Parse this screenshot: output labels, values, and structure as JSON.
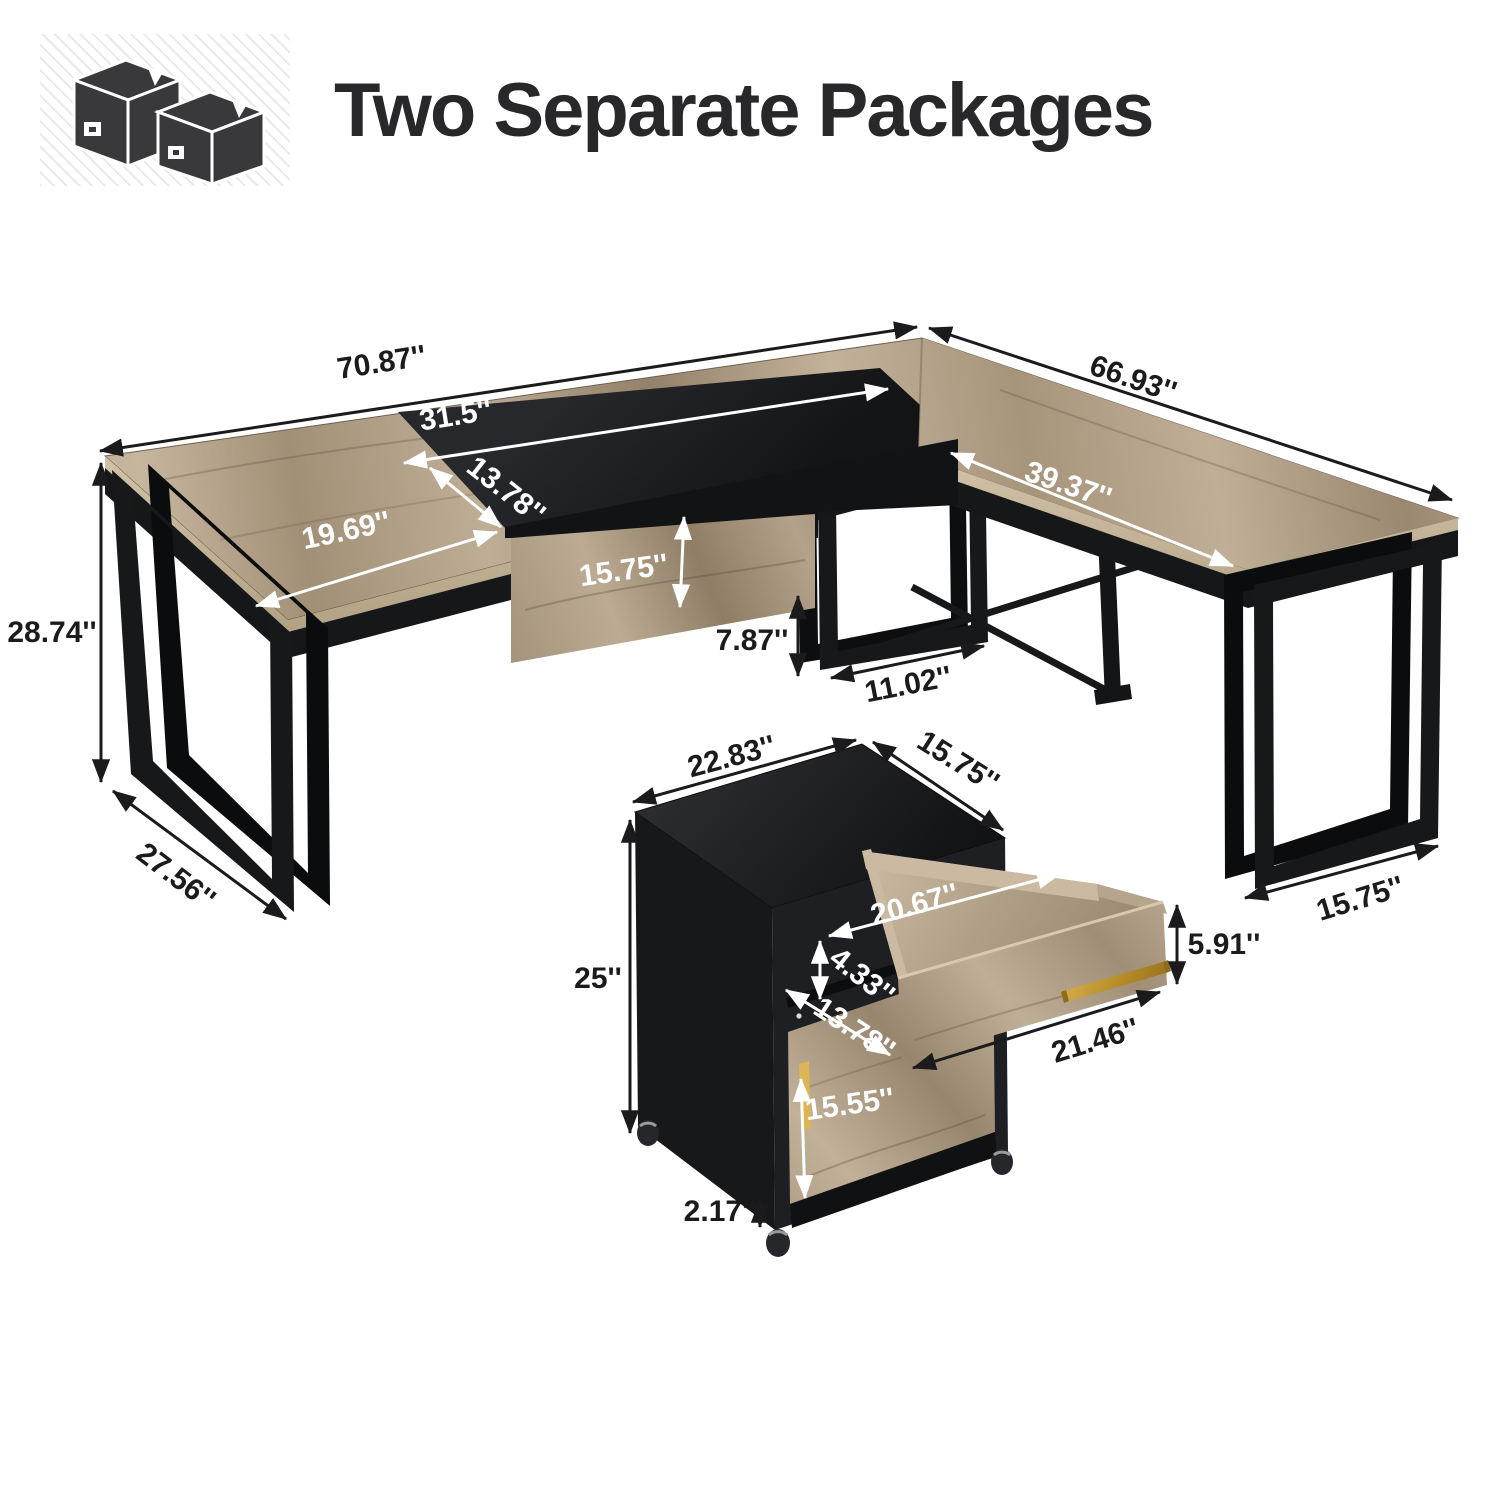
{
  "header": {
    "title": "Two Separate Packages",
    "icon": "two-packages-icon"
  },
  "colors": {
    "wood": "#b7a68e",
    "wood_dark": "#96846b",
    "black_metal": "#17181a",
    "gold": "#c79a2e",
    "text_dark": "#1b1b1d",
    "text_white": "#ffffff"
  },
  "desk": {
    "dims": {
      "total_width": "70.87''",
      "right_side_length": "66.93''",
      "inset_width": "31.5''",
      "inset_depth": "13.78''",
      "front_wood_depth": "19.69''",
      "return_wing_length": "39.37''",
      "modesty_panel_height": "15.75''",
      "desk_height": "28.74''",
      "under_clearance": "7.87''",
      "foot_length": "11.02''",
      "left_leg_depth": "27.56''",
      "right_leg_depth": "15.75''"
    }
  },
  "cabinet": {
    "dims": {
      "width": "22.83''",
      "depth": "15.75''",
      "height": "25''",
      "drawer_inner_width": "20.67''",
      "drawer_inner_height": "4.33''",
      "drawer_front_height": "5.91''",
      "drawer_diagonal": "21.46''",
      "door_width": "13.78''",
      "door_height": "15.55''",
      "caster_height": "2.17''"
    }
  }
}
